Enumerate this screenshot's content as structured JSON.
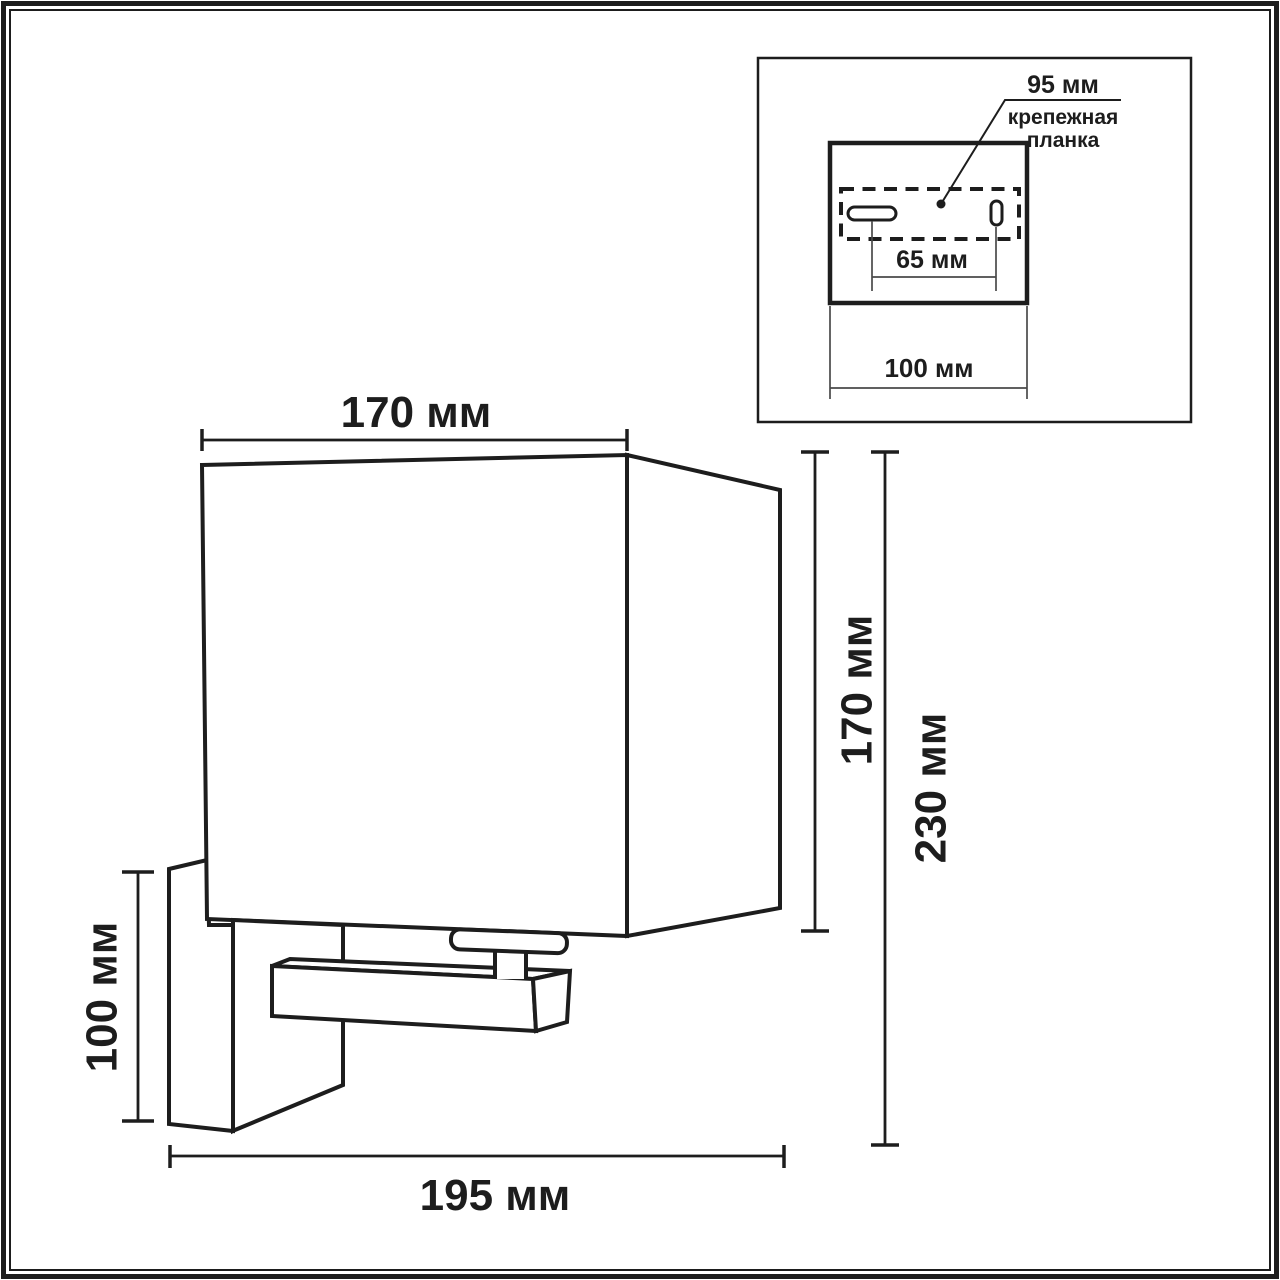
{
  "colors": {
    "line": "#1d1d1d",
    "thin_line": "#4a4a4a",
    "background": "#ffffff"
  },
  "inset": {
    "plate_width_label": "95 мм",
    "plate_name": [
      "крепежная",
      "планка"
    ],
    "hole_spacing_label": "65 мм",
    "base_width_label": "100 мм"
  },
  "dimensions": {
    "shade_width": "170 мм",
    "shade_height": "170 мм",
    "total_height": "230 мм",
    "backplate_height": "100 мм",
    "total_depth": "195 мм"
  }
}
